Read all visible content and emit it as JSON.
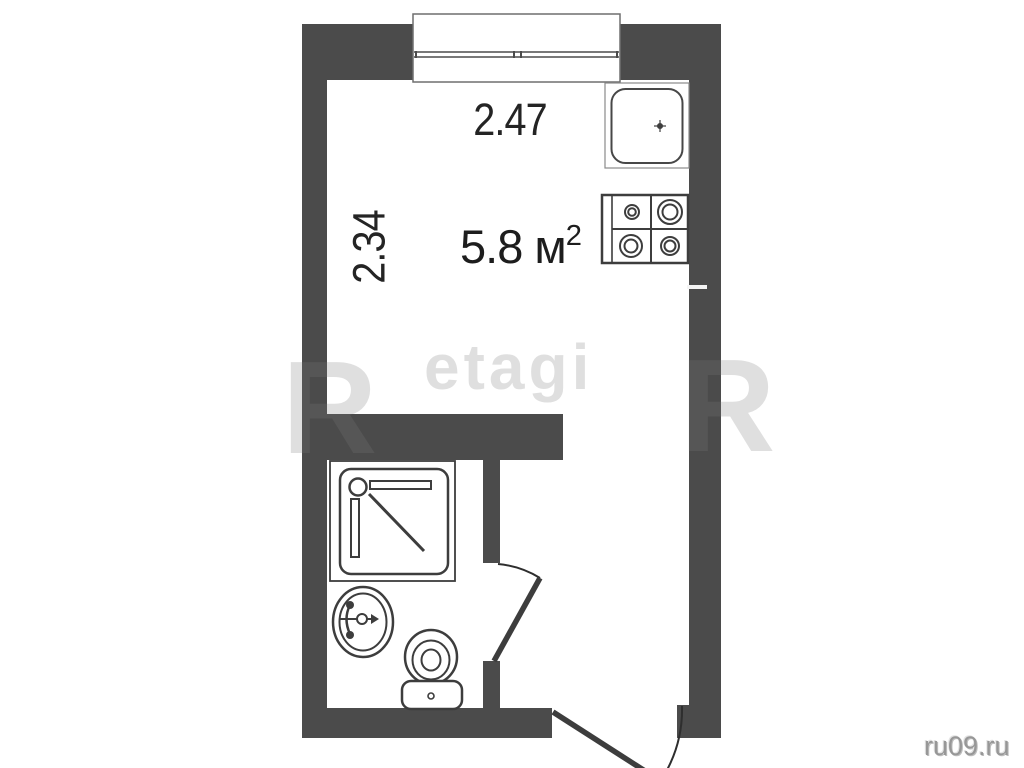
{
  "room": {
    "area_value": "5.8 м",
    "area_sup": "2",
    "dim_horizontal": "2.47",
    "dim_vertical": "2.34"
  },
  "watermarks": {
    "brand": "etagi",
    "left_letter": "R",
    "right_letter": "R"
  },
  "footer": {
    "site": "ru09.ru"
  },
  "fixtures": [
    {
      "name": "window"
    },
    {
      "name": "kitchen-sink"
    },
    {
      "name": "stove-4-burner"
    },
    {
      "name": "shower-tray"
    },
    {
      "name": "washbasin"
    },
    {
      "name": "toilet"
    },
    {
      "name": "bathroom-door"
    },
    {
      "name": "entrance-door"
    }
  ],
  "colors": {
    "wall": "#4b4b4b",
    "background": "#ffffff",
    "fixture_line": "#3d3d3d",
    "text": "#242424",
    "watermark": "#7a7a7a",
    "site_text": "#979797"
  }
}
